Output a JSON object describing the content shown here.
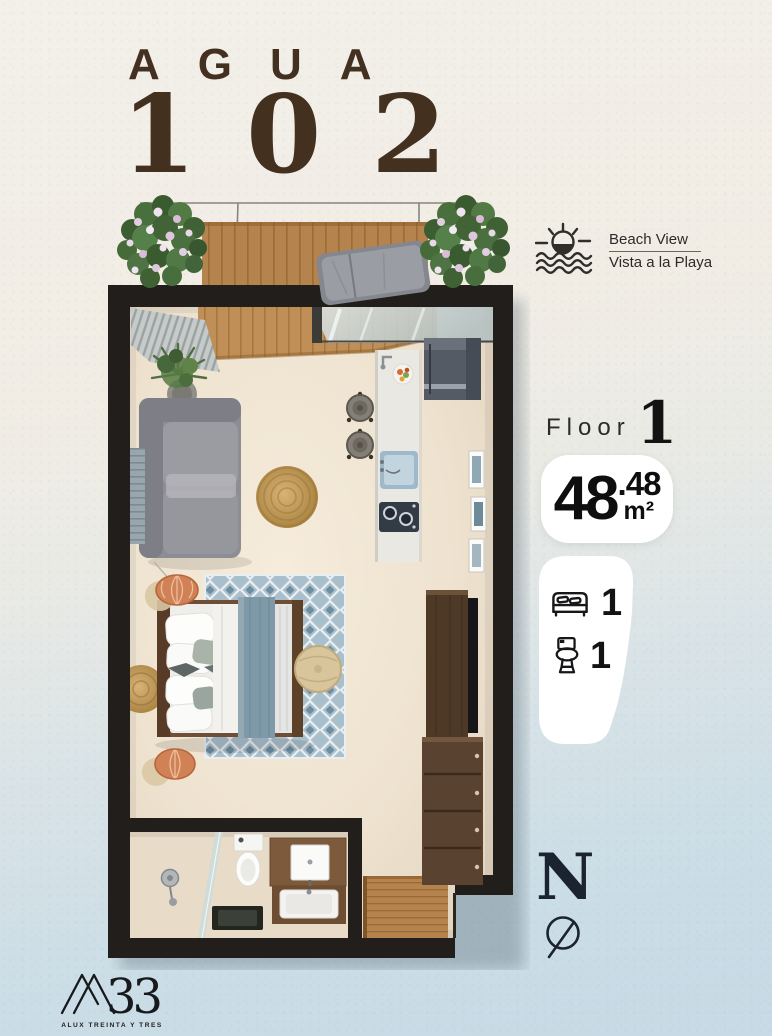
{
  "title": {
    "name": "AGUA",
    "number": "102",
    "color": "#44301f"
  },
  "beach_view": {
    "icon": "sun-over-waves-icon",
    "label_en": "Beach View",
    "label_es": "Vista a la Playa"
  },
  "floor": {
    "label": "Floor",
    "value": "1"
  },
  "area": {
    "value_main": "48",
    "value_sup": ".48",
    "unit": "m²"
  },
  "features": {
    "bedrooms": {
      "icon": "bed-icon",
      "count": "1"
    },
    "bathrooms": {
      "icon": "toilet-icon",
      "count": "1"
    }
  },
  "compass": {
    "label": "N",
    "icon": "compass-needle-icon"
  },
  "logo": {
    "mark": "A33",
    "mark_numerals": "33",
    "tagline": "ALUX TREINTA Y TRES"
  },
  "colors": {
    "background_top": "#f2efe8",
    "background_bottom": "#c7dae5",
    "title_brown": "#44301f",
    "wall_black": "#211e1b",
    "floor_beige": "#eee2d0",
    "deck_wood": "#b5834d",
    "rug_blue": "#a3b8c6",
    "card_white": "#ffffff"
  },
  "floorplan": {
    "type": "studio-unit-top-view",
    "elements": [
      "balcony-deck",
      "balcony-railing",
      "planter-left",
      "planter-right",
      "lounge-chair",
      "curtains",
      "indoor-plant",
      "sliding-glass-door",
      "sofa",
      "wall-hanging",
      "jute-rug",
      "kitchen-counter",
      "sink",
      "cooktop",
      "refrigerator",
      "bar-stools",
      "wall-art",
      "tv-console",
      "dresser",
      "double-bed",
      "area-rug",
      "pouf",
      "pendant-lamps",
      "round-rug",
      "bathroom",
      "shower",
      "toilet",
      "vanity-mirror",
      "vanity-sink",
      "entry-wood-floor"
    ]
  }
}
